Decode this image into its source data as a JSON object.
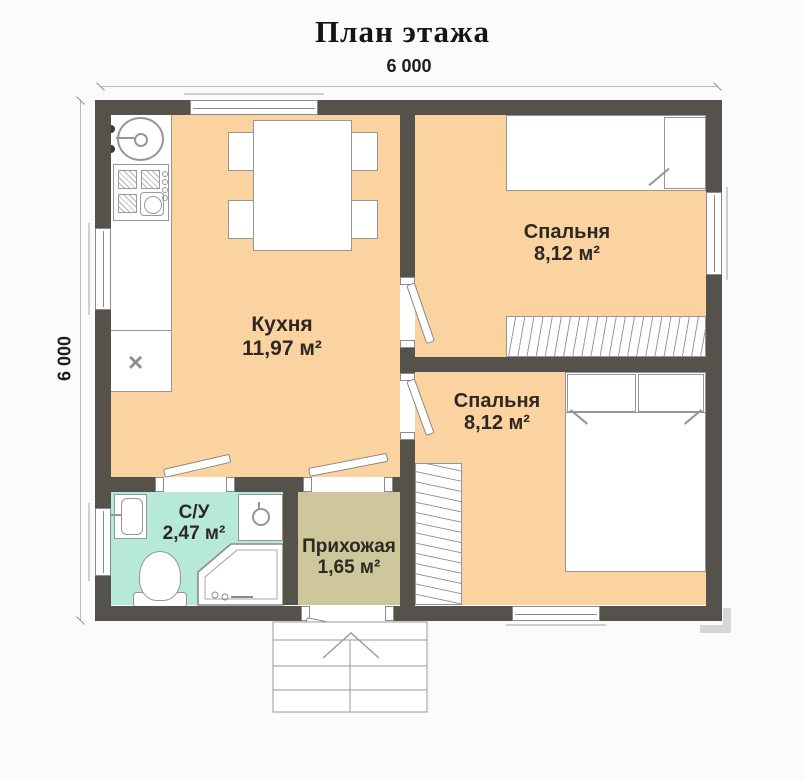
{
  "title": "План этажа",
  "dimensions": {
    "top": "6 000",
    "left": "6 000"
  },
  "rooms": {
    "kitchen": {
      "name": "Кухня",
      "area": "11,97 м²"
    },
    "bedroom_top": {
      "name": "Спальня",
      "area": "8,12 м²"
    },
    "bedroom_bottom": {
      "name": "Спальня",
      "area": "8,12 м²"
    },
    "bathroom": {
      "name": "С/У",
      "area": "2,47 м²"
    },
    "hallway": {
      "name": "Прихожая",
      "area": "1,65 м²"
    }
  },
  "symbols": {
    "cabinet_mark": "×"
  },
  "colors": {
    "background": "#fbfbfb",
    "floor": "#fbd3a0",
    "bathroom_floor": "#b6e9da",
    "hallway_floor": "#cfc79c",
    "wall": "#55524b",
    "outline": "#969696",
    "text": "#2d2823"
  }
}
